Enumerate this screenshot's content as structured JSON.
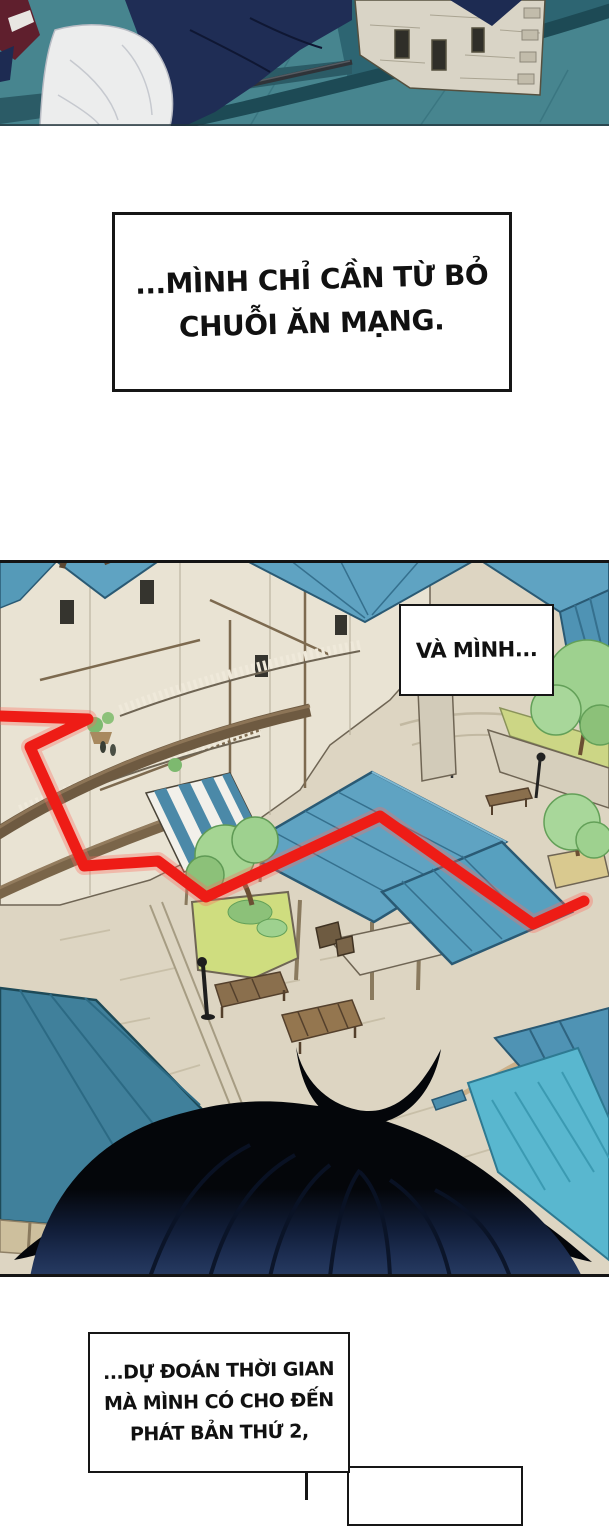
{
  "comic": {
    "title": "manhwa-page",
    "captions": {
      "c1_line1": "...MÌNH CHỈ CẦN TỪ BỎ",
      "c1_line2": "CHUỖI ĂN MẠNG.",
      "c2": "VÀ MÌNH...",
      "c3_line1": "...DỰ ĐOÁN THỜI GIAN",
      "c3_line2": "MÀ MÌNH CÓ CHO ĐẾN",
      "c3_line3": "PHÁT BẢN THỨ 2,"
    },
    "palette": {
      "page_bg": "#ffffff",
      "border_black": "#161616",
      "rooftop_teal": "#47858f",
      "rooftop_dark_band": "#1d4a55",
      "jacket_navy": "#1f2d55",
      "stone_wall": "#e7e1d2",
      "pavement": "#ddd5c2",
      "roof_blue": "#5fa3c2",
      "roof_bright_blue": "#59b7cf",
      "awning_teal": "#40809b",
      "route_red": "#ee1c16",
      "tree_green": "#9ed18f",
      "planter_green": "#cfdd7f",
      "hair_black": "#04060a",
      "hair_navy": "#273c63",
      "flag_maroon": "#5f1f2d"
    }
  }
}
